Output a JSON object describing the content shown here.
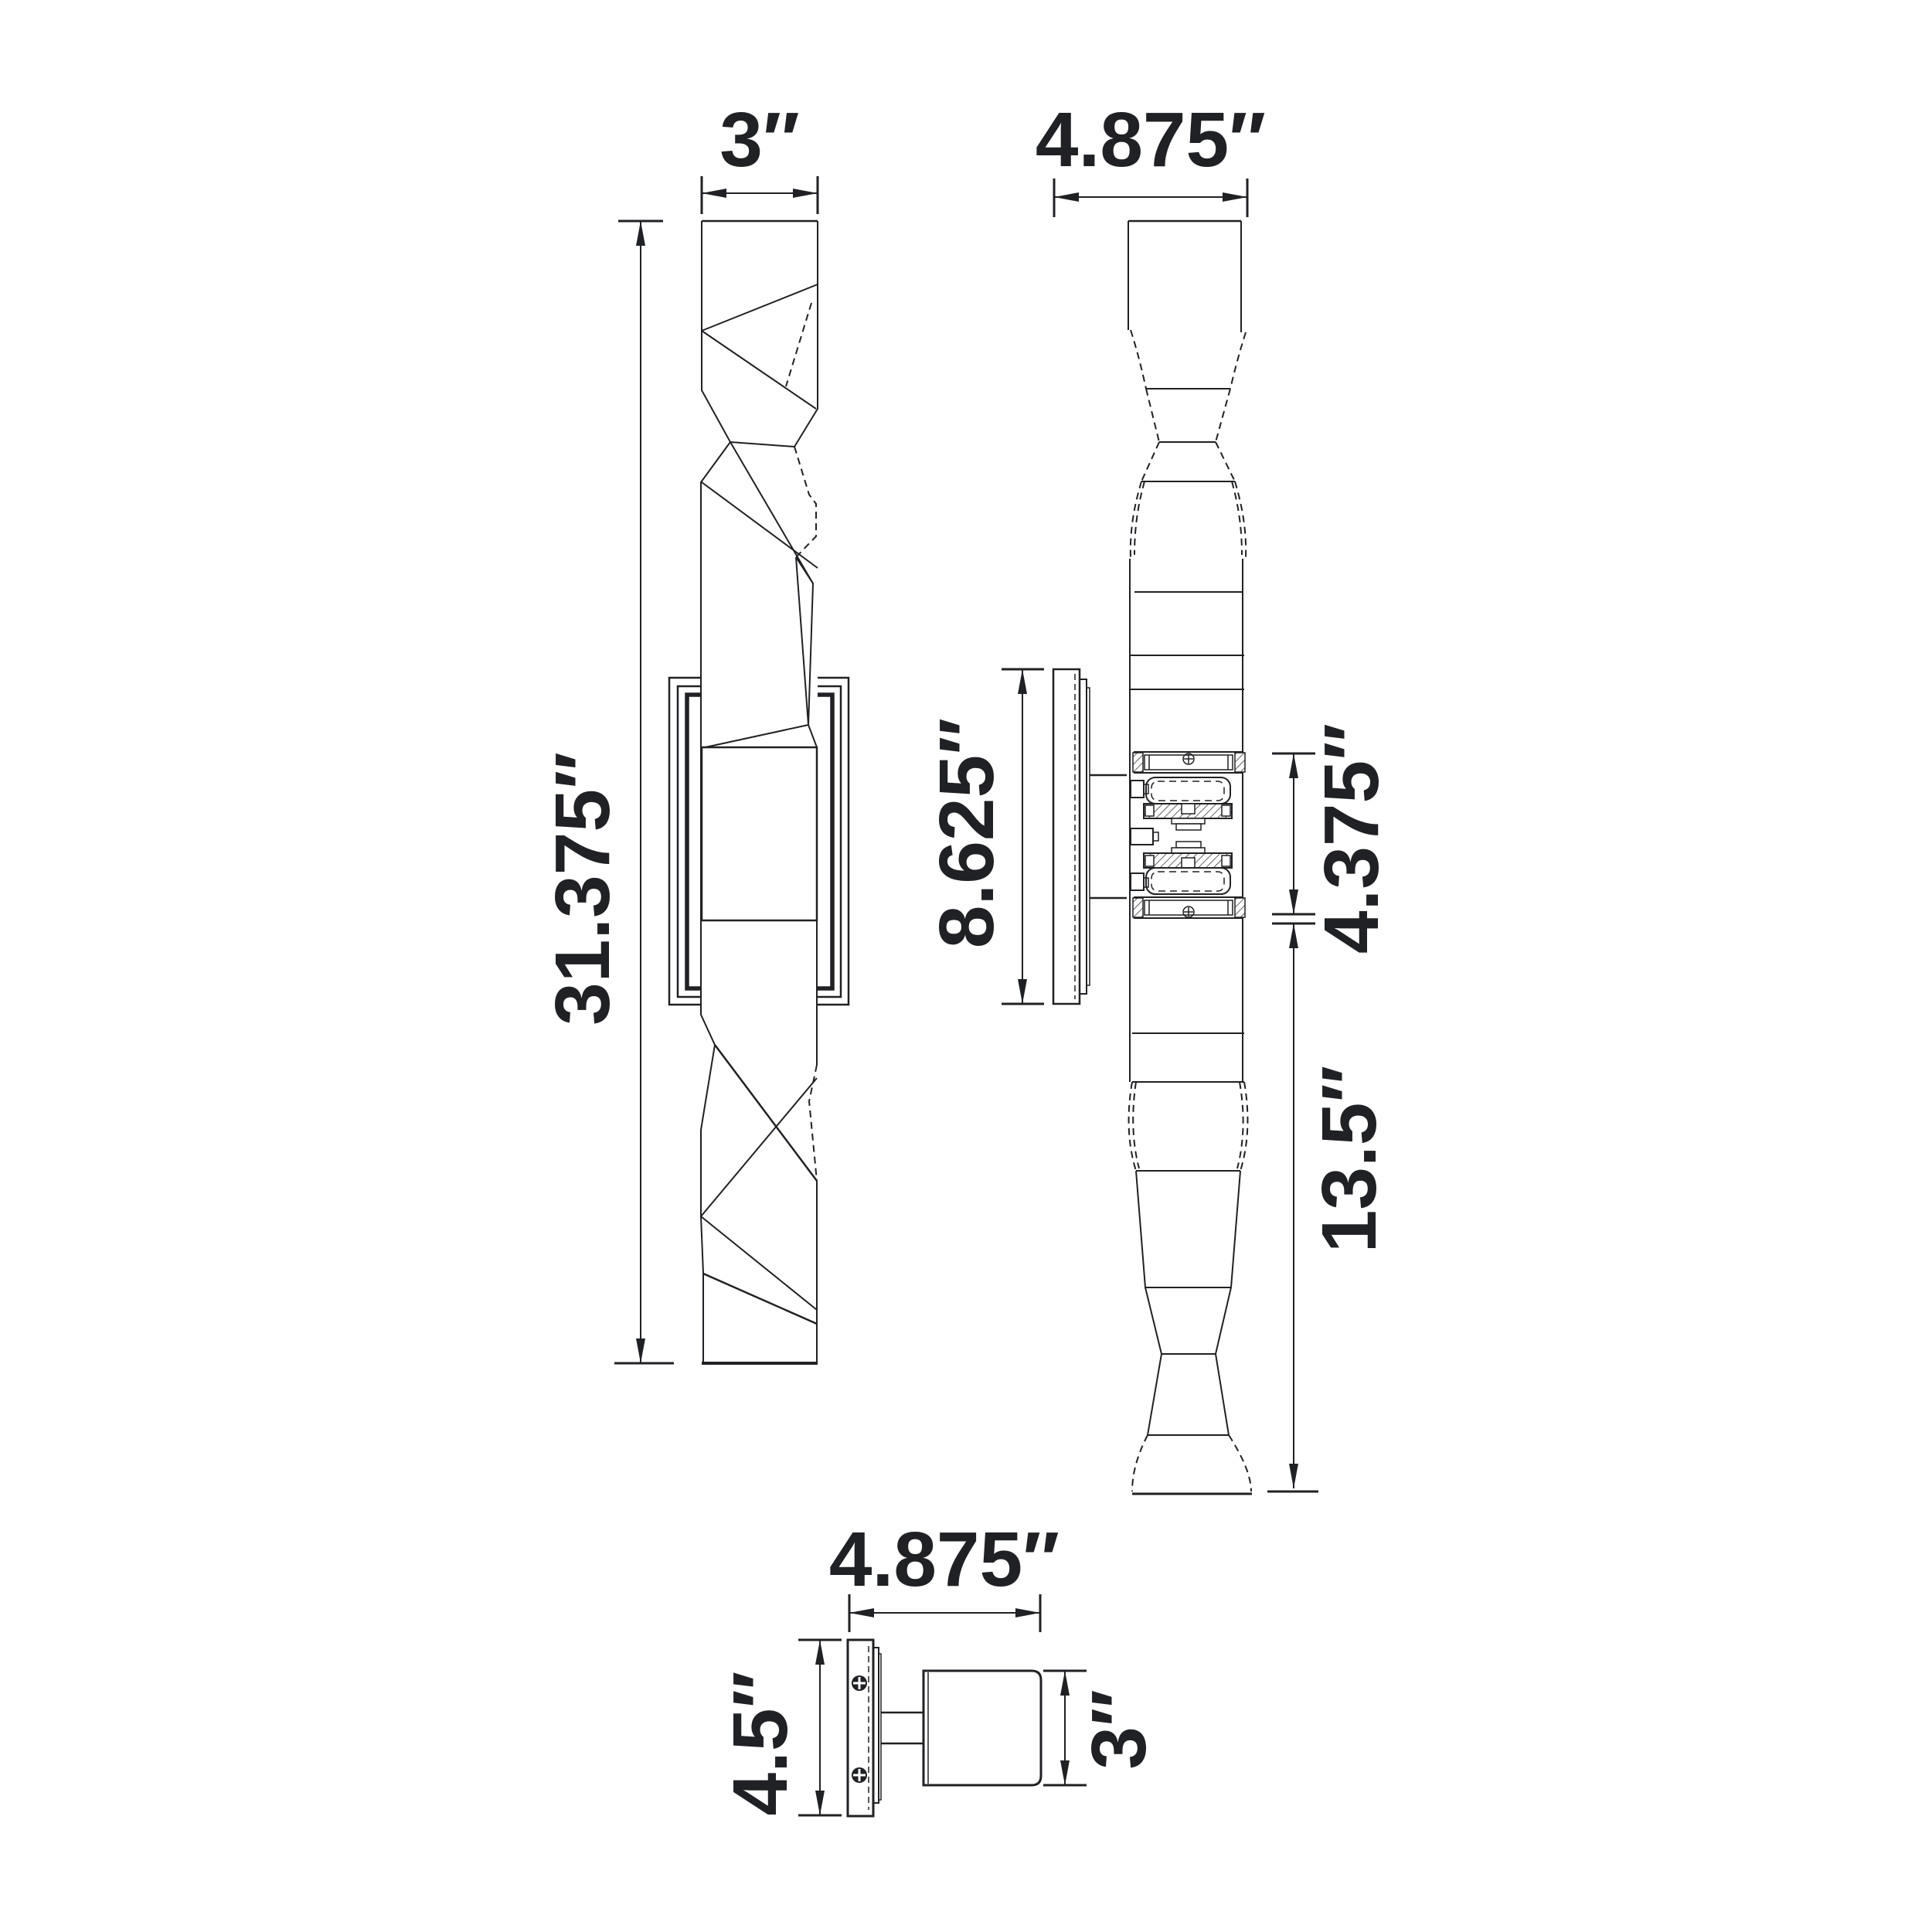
{
  "colors": {
    "line": "#202124",
    "background": "#ffffff"
  },
  "dims": {
    "front_width": "3″",
    "overall_height": "31.375″",
    "side_projection": "4.875″",
    "backplate_height": "8.625″",
    "center_section_height": "4.375″",
    "lower_section_height": "13.5″",
    "top_view_projection": "4.875″",
    "backplate_width": "4.5″",
    "body_depth": "3″"
  }
}
